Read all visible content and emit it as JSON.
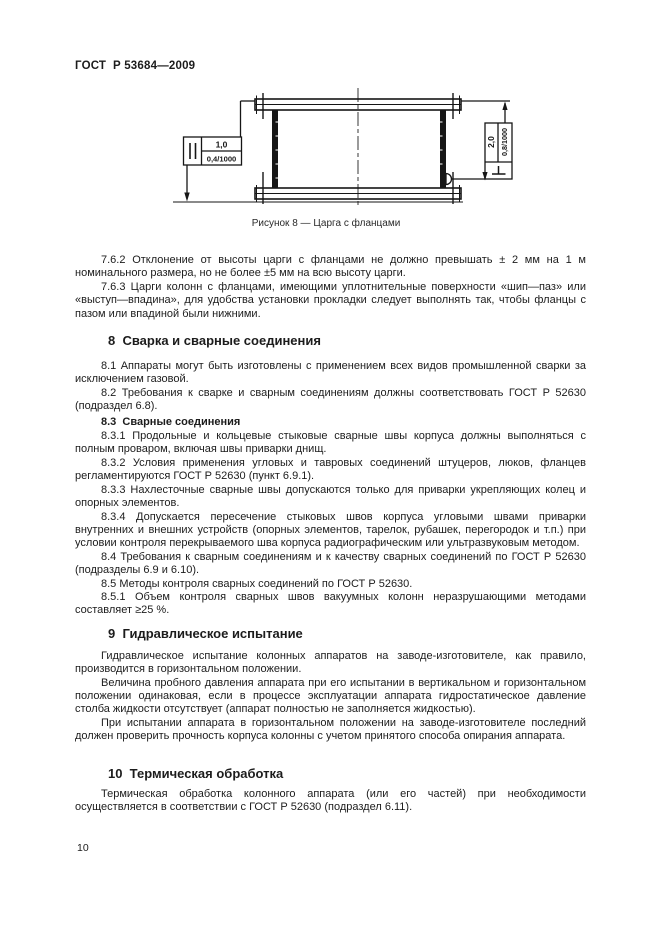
{
  "meta": {
    "doc_number": "ГОСТ  Р 53684—2009",
    "page_number": "10"
  },
  "figure": {
    "caption": "Рисунок 8 — Царга с фланцами",
    "parallelism": {
      "tol_mm": "1,0",
      "tol_per_m": "0,4/1000"
    },
    "perpendicularity": {
      "tol_mm": "2,0",
      "tol_per_m": "0,8/1000"
    }
  },
  "content": {
    "p762": "7.6.2  Отклонение от высоты царги с фланцами не должно превышать ± 2 мм на 1 м номинального размера, но не более ±5 мм на всю высоту царги.",
    "p763": "7.6.3  Царги колонн с фланцами, имеющими уплотнительные поверхности «шип—паз» или «выступ—впадина», для удобства установки прокладки следует выполнять так, чтобы фланцы с пазом или впадиной были нижними.",
    "h8": "8  Сварка и сварные соединения",
    "p81": "8.1  Аппараты могут быть изготовлены с применением всех видов промышленной сварки за исключением газовой.",
    "p82": "8.2  Требования к сварке и сварным соединениям должны соответствовать ГОСТ Р 52630 (подраздел 6.8).",
    "h83": "8.3  Сварные соединения",
    "p831": "8.3.1  Продольные и кольцевые стыковые сварные швы корпуса должны выполняться с полным проваром, включая швы приварки днищ.",
    "p832": "8.3.2  Условия применения угловых и тавровых соединений штуцеров, люков, фланцев регламентируются ГОСТ Р 52630 (пункт 6.9.1).",
    "p833": "8.3.3  Нахлесточные сварные швы допускаются только для приварки укрепляющих колец и опорных элементов.",
    "p834": "8.3.4  Допускается пересечение стыковых швов корпуса угловыми швами приварки внутренних и внешних устройств (опорных элементов, тарелок, рубашек, перегородок и т.п.) при условии контроля перекрываемого шва корпуса радиографическим или ультразвуковым методом.",
    "p84": "8.4  Требования к сварным соединениям и к качеству сварных соединений по ГОСТ Р 52630 (подразделы 6.9 и 6.10).",
    "p85": "8.5  Методы контроля сварных соединений по ГОСТ Р 52630.",
    "p851": "8.5.1  Объем контроля сварных швов вакуумных колонн неразрушающими методами составляет ≥25 %.",
    "h9": "9  Гидравлическое испытание",
    "p9a": "Гидравлическое испытание колонных аппаратов на заводе-изготовителе, как правило, производится в горизонтальном положении.",
    "p9b": "Величина пробного давления аппарата при его испытании в вертикальном и горизонтальном положении одинаковая, если в процессе эксплуатации аппарата гидростатическое давление столба жидкости отсутствует (аппарат полностью не заполняется жидкостью).",
    "p9c": "При испытании аппарата в горизонтальном положении на заводе-изготовителе последний должен проверить прочность корпуса колонны с учетом принятого способа опирания аппарата.",
    "h10": "10  Термическая обработка",
    "p10a": "Термическая обработка колонного аппарата (или его частей) при необходимости осуществляется в соответствии с ГОСТ Р 52630 (подраздел 6.11)."
  }
}
